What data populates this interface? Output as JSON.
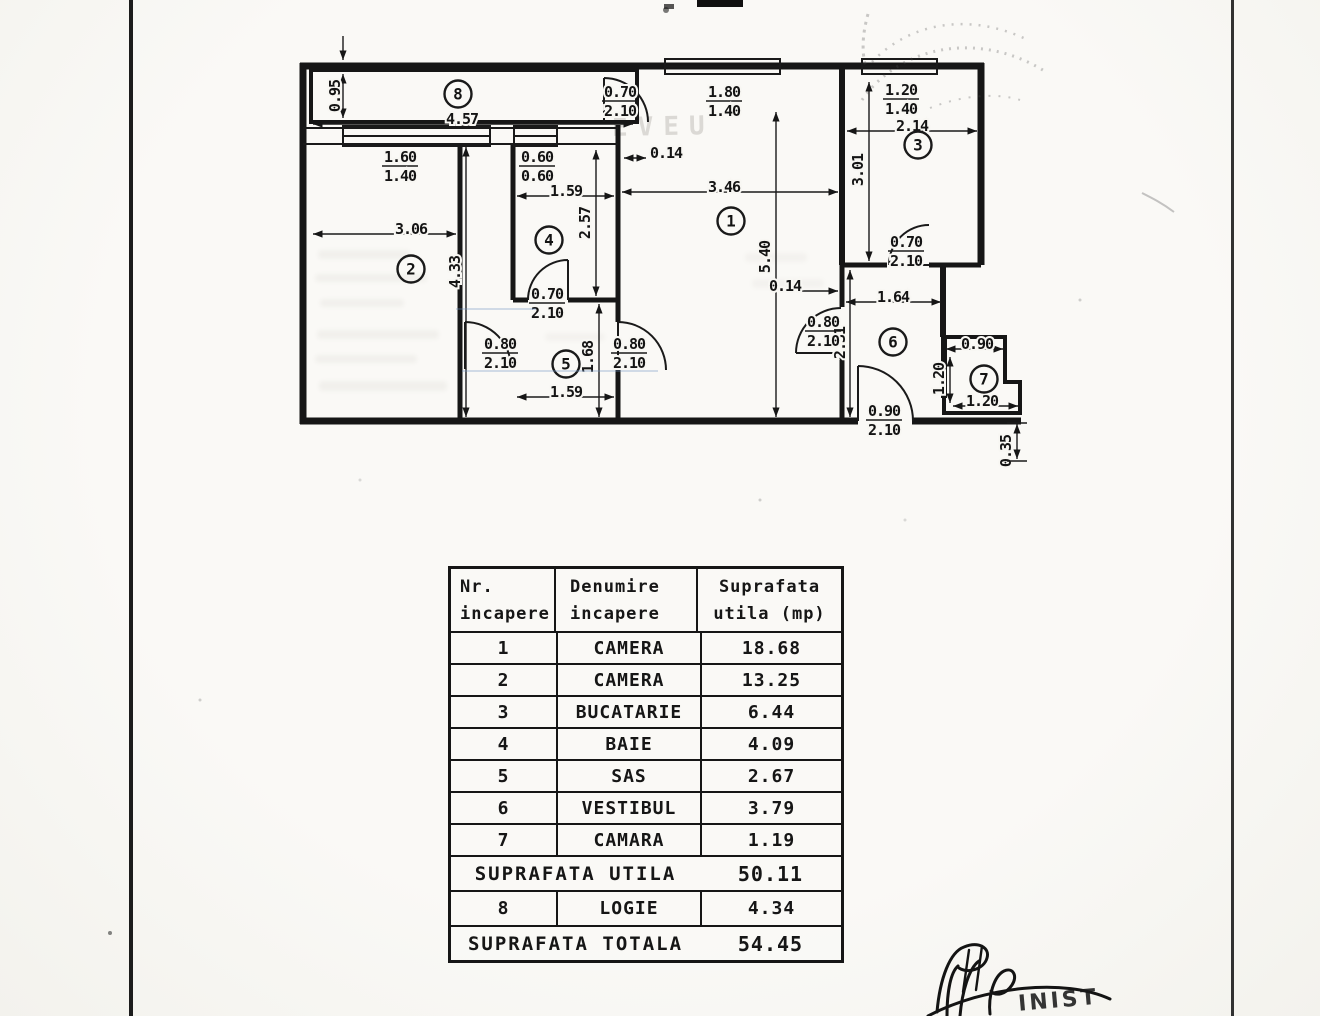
{
  "plan": {
    "room_numbers": [
      "1",
      "2",
      "3",
      "4",
      "5",
      "6",
      "7",
      "8"
    ],
    "dims": {
      "singles": [
        "0.95",
        "4.57",
        "2.14",
        "3.01",
        "0.14",
        "1.59",
        "3.46",
        "2.57",
        "3.06",
        "4.33",
        "5.40",
        "0.14",
        "1.64",
        "2.31",
        "1.68",
        "1.59",
        "0.90",
        "1.20",
        "1.20",
        "0.35"
      ],
      "fractions": [
        {
          "w": "0.70",
          "h": "2.10"
        },
        {
          "w": "1.80",
          "h": "1.40"
        },
        {
          "w": "1.20",
          "h": "1.40"
        },
        {
          "w": "1.60",
          "h": "1.40"
        },
        {
          "w": "0.60",
          "h": "0.60"
        },
        {
          "w": "0.70",
          "h": "2.10"
        },
        {
          "w": "0.70",
          "h": "2.10"
        },
        {
          "w": "0.80",
          "h": "2.10"
        },
        {
          "w": "0.80",
          "h": "2.10"
        },
        {
          "w": "0.80",
          "h": "2.10"
        },
        {
          "w": "0.90",
          "h": "2.10"
        }
      ]
    }
  },
  "table": {
    "headers": [
      [
        "Nr.",
        "incapere"
      ],
      [
        "Denumire",
        "incapere"
      ],
      [
        "Suprafata",
        "utila (mp)"
      ]
    ],
    "rows": [
      [
        "1",
        "CAMERA",
        "18.68"
      ],
      [
        "2",
        "CAMERA",
        "13.25"
      ],
      [
        "3",
        "BUCATARIE",
        "6.44"
      ],
      [
        "4",
        "BAIE",
        "4.09"
      ],
      [
        "5",
        "SAS",
        "2.67"
      ],
      [
        "6",
        "VESTIBUL",
        "3.79"
      ],
      [
        "7",
        "CAMARA",
        "1.19"
      ]
    ],
    "suprafata_utila": {
      "label": "SUPRAFATA UTILA",
      "value": "50.11"
    },
    "logie_row": [
      "8",
      "LOGIE",
      "4.34"
    ],
    "suprafata_totala": {
      "label": "SUPRAFATA TOTALA",
      "value": "54.45"
    }
  },
  "artifacts": {
    "ghost_text": "EVEU",
    "signature_text": "INIST"
  }
}
